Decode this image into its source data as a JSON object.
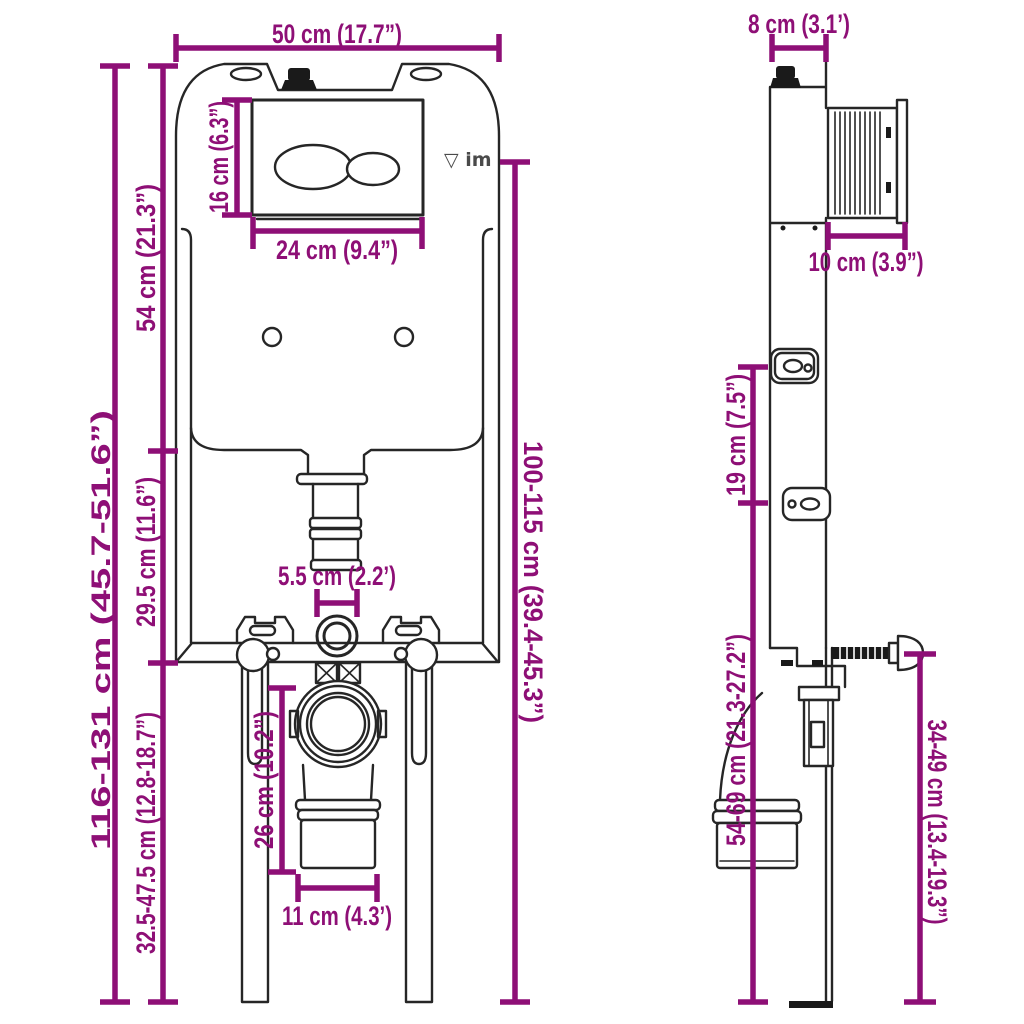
{
  "diagram": {
    "subject": "concealed-cistern-mounting-frame-dimension-diagram",
    "views": [
      "front",
      "side"
    ]
  },
  "colors": {
    "dimension": "#8E0F76",
    "line": "#262626",
    "background": "#FFFFFF"
  },
  "logo": {
    "text": "▽ im"
  },
  "front": {
    "width": "50 cm (17.7”)",
    "total_height": "116-131 cm (45.7-51.6”)",
    "upper_height": "54 cm (21.3”)",
    "mid_height": "29.5 cm (11.6”)",
    "leg_height": "32.5-47.5 cm (12.8-18.7”)",
    "frame_height": "100-115 cm (39.4-45.3”)",
    "plate_height": "16 cm (6.3”)",
    "plate_width": "24 cm (9.4”)",
    "inlet_width": "5.5 cm (2.2’)",
    "outlet_drop": "26 cm (10.2”)",
    "outlet_width": "11 cm (4.3’)"
  },
  "side": {
    "depth": "8 cm (3.1’)",
    "box_depth": "10 cm (3.9”)",
    "bracket_gap": "19 cm (7.5”)",
    "outlet_height": "54-69 cm (21.3-27.2”)",
    "anchor_height": "34-49 cm (13.4-19.3”)"
  }
}
